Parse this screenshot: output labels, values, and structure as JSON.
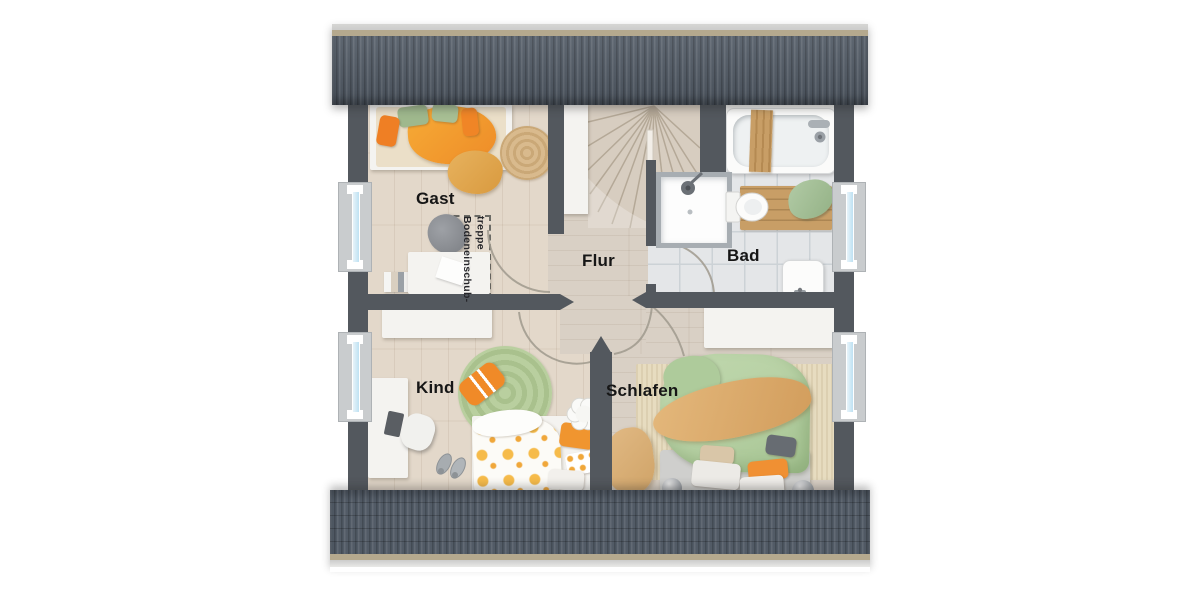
{
  "rooms": [
    {
      "id": "gast",
      "label": "Gast"
    },
    {
      "id": "flur",
      "label": "Flur"
    },
    {
      "id": "bad",
      "label": "Bad"
    },
    {
      "id": "kind",
      "label": "Kind"
    },
    {
      "id": "schlafen",
      "label": "Schlafen"
    }
  ],
  "annotations": {
    "attic_hatch_line1": "Bodeneinschub-",
    "attic_hatch_line2": "treppe"
  },
  "theme": {
    "wall": "#53585e",
    "roof": "#525b66",
    "roof_trim": "#b5a98e",
    "roof_ridge": "#cccccb",
    "floor_wood": "#e3d8ca",
    "floor_wood_dark": "#d9d0c5",
    "floor_tile": "#e4e6e8",
    "tile_line": "#ccd2d6",
    "stair_wood": "#d7cdc0",
    "window_glass": "#bee1f2",
    "window_frame": "#c9ccce",
    "furniture_white": "#f4f3f0",
    "accent_orange": "#ef8a2a",
    "accent_mustard": "#dfa851",
    "accent_green": "#a9c49a",
    "duvet_green": "#b6d0a3",
    "rug_green": "#b9cf9f",
    "rug_tan": "#d9ba8d",
    "wood_accent": "#c89e66",
    "arc": "#a09a8e",
    "text": "#161616"
  }
}
